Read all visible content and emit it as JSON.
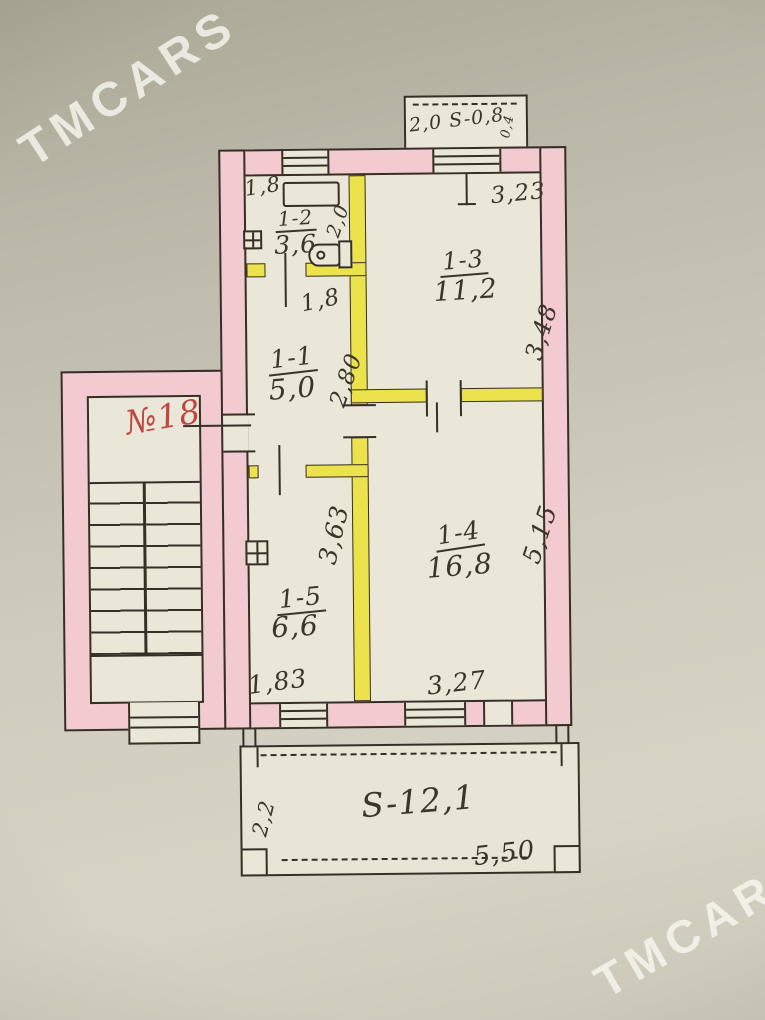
{
  "watermark": {
    "text": "TMCARS"
  },
  "plan": {
    "unit_number": "№18",
    "vent_box": {
      "area_label": "2,0 S-0,8",
      "side_dim": "0,4"
    },
    "rooms": {
      "bathroom": {
        "name": "1-2",
        "area": "3,6",
        "dim_width": "1,8",
        "dim_depth": "2,0"
      },
      "hall": {
        "name": "1-1",
        "area": "5,0",
        "dim_width": "1,8",
        "dim_depth": "2,80"
      },
      "room_large": {
        "name": "1-3",
        "area": "11,2",
        "dim_width": "3,23",
        "dim_depth": "3,48"
      },
      "living_room": {
        "name": "1-4",
        "area": "16,8",
        "dim_width": "3,27",
        "dim_depth": "5,15"
      },
      "kitchen": {
        "name": "1-5",
        "area": "6,6",
        "dim_width": "1,83",
        "dim_depth": "3,63"
      }
    },
    "balcony": {
      "area_label": "S-12,1",
      "dim_width": "5,50",
      "dim_depth": "2,2"
    }
  },
  "colors": {
    "bearing_wall": "#f3cad0",
    "partition_wall": "#ebe24c",
    "unit_label": "#c0473f",
    "ink": "#352f26"
  }
}
